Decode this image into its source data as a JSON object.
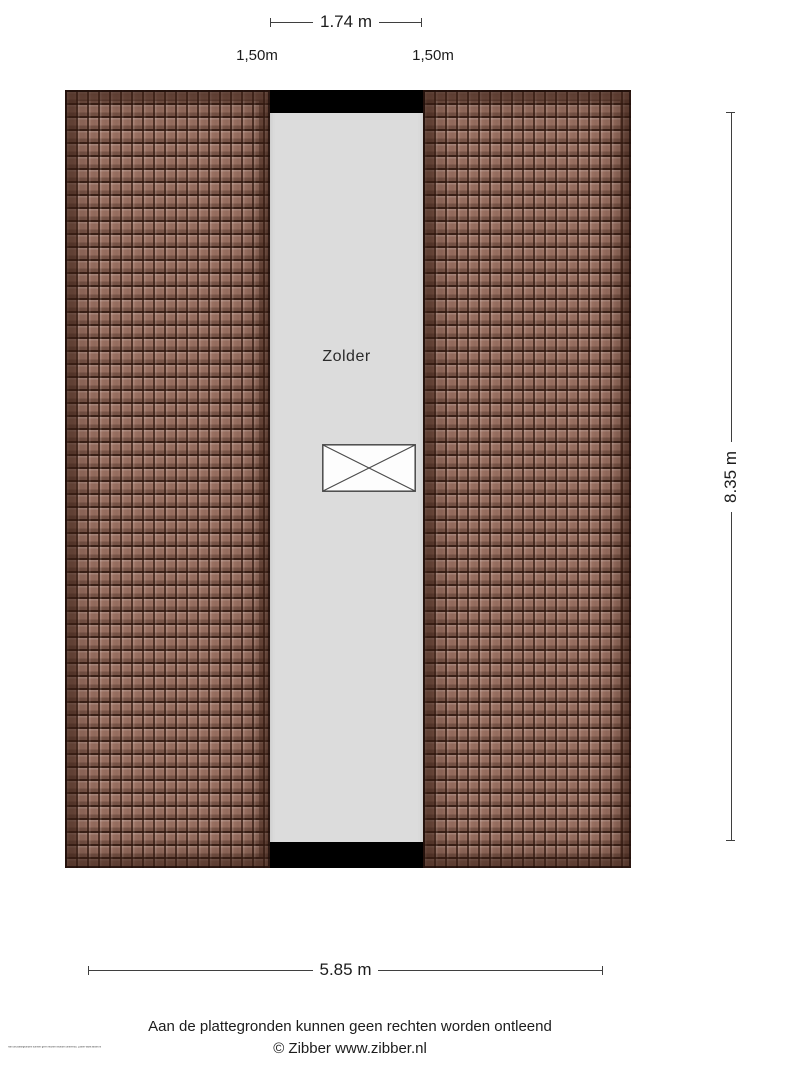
{
  "title": "Zolder plattegrond",
  "plan": {
    "room_label": "Zolder"
  },
  "dimensions": {
    "top": {
      "label": "1.74 m"
    },
    "sub_left": {
      "label": "1,50m"
    },
    "sub_right": {
      "label": "1,50m"
    },
    "right": {
      "label": "8.35 m"
    },
    "bottom": {
      "label": "5.85 m"
    }
  },
  "footer": {
    "disclaimer": "Aan de plattegronden kunnen geen rechten worden ontleend",
    "copyright": "© Zibber www.zibber.nl",
    "fine_print": "Aan de plattegronden kunnen geen rechten worden ontleend | Zibber www.zibber.nl"
  },
  "colors": {
    "roof_tile_base": "#9c7263",
    "roof_tile_line": "#31180f",
    "attic_floor": "#dcdcdc",
    "wall": "#000000",
    "dimension_line": "#3f3f3f",
    "text": "#1c1c1c"
  }
}
